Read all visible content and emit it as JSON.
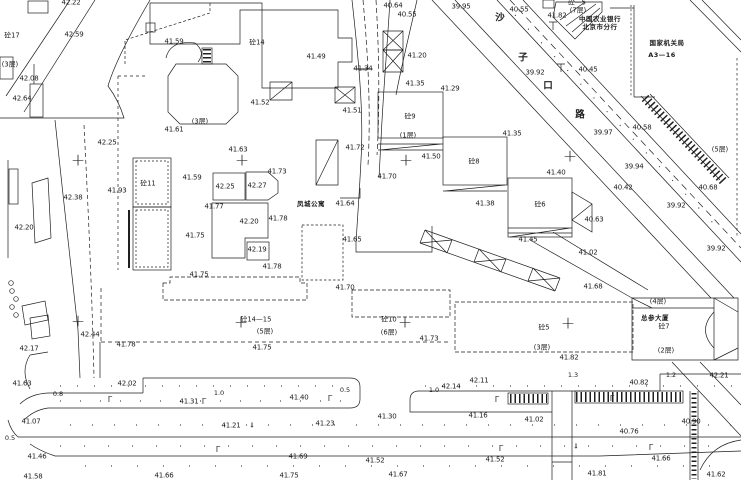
{
  "canvas": {
    "width": 741,
    "height": 480,
    "background": "#ffffff",
    "ink": "#1c1c1c"
  },
  "symbols": {
    "cross_glyph": "+",
    "lamp_glyph": "Γ",
    "arrow_glyph": "⇓"
  },
  "labels": {
    "elevations": [
      {
        "t": "42.22",
        "x": 71,
        "y": 3
      },
      {
        "t": "42.59",
        "x": 74,
        "y": 35
      },
      {
        "t": "41.59",
        "x": 174,
        "y": 42
      },
      {
        "t": "42.08",
        "x": 29,
        "y": 79
      },
      {
        "t": "42.64",
        "x": 22,
        "y": 99
      },
      {
        "t": "41.61",
        "x": 174,
        "y": 130
      },
      {
        "t": "42.25",
        "x": 107,
        "y": 143
      },
      {
        "t": "41.63",
        "x": 238,
        "y": 150
      },
      {
        "t": "40.64",
        "x": 393,
        "y": 6
      },
      {
        "t": "40.55",
        "x": 407,
        "y": 15
      },
      {
        "t": "39.95",
        "x": 461,
        "y": 7
      },
      {
        "t": "40.55",
        "x": 519,
        "y": 10
      },
      {
        "t": "41.82",
        "x": 557,
        "y": 16
      },
      {
        "t": "41.49",
        "x": 316,
        "y": 57
      },
      {
        "t": "41.34",
        "x": 363,
        "y": 69,
        "s": 1
      },
      {
        "t": "41.20",
        "x": 417,
        "y": 56
      },
      {
        "t": "41.35",
        "x": 415,
        "y": 84
      },
      {
        "t": "41.29",
        "x": 450,
        "y": 89
      },
      {
        "t": "41.52",
        "x": 260,
        "y": 103
      },
      {
        "t": "41.51",
        "x": 352,
        "y": 111
      },
      {
        "t": "41.35",
        "x": 512,
        "y": 134
      },
      {
        "t": "39.92",
        "x": 535,
        "y": 73
      },
      {
        "t": "40.45",
        "x": 588,
        "y": 70
      },
      {
        "t": "40.58",
        "x": 642,
        "y": 128
      },
      {
        "t": "39.97",
        "x": 603,
        "y": 133
      },
      {
        "t": "39.94",
        "x": 634,
        "y": 167
      },
      {
        "t": "40.42",
        "x": 623,
        "y": 188
      },
      {
        "t": "39.92",
        "x": 676,
        "y": 206
      },
      {
        "t": "40.68",
        "x": 708,
        "y": 188
      },
      {
        "t": "40.63",
        "x": 594,
        "y": 220
      },
      {
        "t": "39.92",
        "x": 716,
        "y": 249
      },
      {
        "t": "41.93",
        "x": 117,
        "y": 191
      },
      {
        "t": "41.59",
        "x": 192,
        "y": 178
      },
      {
        "t": "42.25",
        "x": 225,
        "y": 187
      },
      {
        "t": "42.27",
        "x": 257,
        "y": 186
      },
      {
        "t": "41.73",
        "x": 277,
        "y": 172
      },
      {
        "t": "41.77",
        "x": 214,
        "y": 207
      },
      {
        "t": "42.20",
        "x": 249,
        "y": 222
      },
      {
        "t": "41.78",
        "x": 278,
        "y": 219
      },
      {
        "t": "41.75",
        "x": 195,
        "y": 236
      },
      {
        "t": "42.19",
        "x": 257,
        "y": 250
      },
      {
        "t": "41.78",
        "x": 272,
        "y": 267
      },
      {
        "t": "41.75",
        "x": 199,
        "y": 275
      },
      {
        "t": "41.64",
        "x": 345,
        "y": 204
      },
      {
        "t": "41.70",
        "x": 387,
        "y": 177
      },
      {
        "t": "41.72",
        "x": 355,
        "y": 148
      },
      {
        "t": "41.50",
        "x": 431,
        "y": 157
      },
      {
        "t": "41.65",
        "x": 352,
        "y": 240
      },
      {
        "t": "41.70",
        "x": 345,
        "y": 288
      },
      {
        "t": "42.38",
        "x": 73,
        "y": 198
      },
      {
        "t": "42.20",
        "x": 24,
        "y": 228
      },
      {
        "t": "42.44",
        "x": 90,
        "y": 335
      },
      {
        "t": "42.17",
        "x": 29,
        "y": 349
      },
      {
        "t": "41.78",
        "x": 126,
        "y": 345
      },
      {
        "t": "41.40",
        "x": 556,
        "y": 173
      },
      {
        "t": "41.38",
        "x": 485,
        "y": 204
      },
      {
        "t": "41.45",
        "x": 528,
        "y": 240
      },
      {
        "t": "41.02",
        "x": 588,
        "y": 253
      },
      {
        "t": "41.68",
        "x": 593,
        "y": 287
      },
      {
        "t": "41.82",
        "x": 569,
        "y": 358
      },
      {
        "t": "41.75",
        "x": 262,
        "y": 348
      },
      {
        "t": "41.73",
        "x": 429,
        "y": 339
      },
      {
        "t": "41.63",
        "x": 22,
        "y": 384
      },
      {
        "t": "42.02",
        "x": 127,
        "y": 384
      },
      {
        "t": "41.31",
        "x": 189,
        "y": 402
      },
      {
        "t": "41.40",
        "x": 299,
        "y": 398
      },
      {
        "t": "42.14",
        "x": 451,
        "y": 387
      },
      {
        "t": "42.11",
        "x": 479,
        "y": 381
      },
      {
        "t": "40.82",
        "x": 639,
        "y": 383
      },
      {
        "t": "42.21",
        "x": 719,
        "y": 376
      },
      {
        "t": "41.07",
        "x": 31,
        "y": 422
      },
      {
        "t": "41.21",
        "x": 231,
        "y": 426
      },
      {
        "t": "41.23",
        "x": 325,
        "y": 424
      },
      {
        "t": "41.30",
        "x": 387,
        "y": 417
      },
      {
        "t": "41.16",
        "x": 478,
        "y": 416
      },
      {
        "t": "41.02",
        "x": 534,
        "y": 420
      },
      {
        "t": "40.76",
        "x": 629,
        "y": 432
      },
      {
        "t": "40.90",
        "x": 691,
        "y": 422
      },
      {
        "t": "41.46",
        "x": 37,
        "y": 457
      },
      {
        "t": "41.58",
        "x": 33,
        "y": 477
      },
      {
        "t": "41.66",
        "x": 164,
        "y": 476
      },
      {
        "t": "41.69",
        "x": 298,
        "y": 457
      },
      {
        "t": "41.75",
        "x": 289,
        "y": 476
      },
      {
        "t": "41.52",
        "x": 375,
        "y": 461
      },
      {
        "t": "41.67",
        "x": 398,
        "y": 475
      },
      {
        "t": "41.52",
        "x": 495,
        "y": 460
      },
      {
        "t": "41.66",
        "x": 661,
        "y": 459
      },
      {
        "t": "41.81",
        "x": 597,
        "y": 474
      },
      {
        "t": "41.62",
        "x": 716,
        "y": 475
      }
    ],
    "buildings": [
      {
        "t": "砼17",
        "x": 12,
        "y": 36
      },
      {
        "t": "砼14",
        "x": 257,
        "y": 43
      },
      {
        "t": "砼—5",
        "x": 577,
        "y": 3
      },
      {
        "t": "砼11",
        "x": 148,
        "y": 184
      },
      {
        "t": "砼9",
        "x": 410,
        "y": 117
      },
      {
        "t": "砼8",
        "x": 474,
        "y": 162
      },
      {
        "t": "砼6",
        "x": 540,
        "y": 205
      },
      {
        "t": "砼14—15",
        "x": 256,
        "y": 320
      },
      {
        "t": "砼10",
        "x": 389,
        "y": 320
      },
      {
        "t": "砼5",
        "x": 544,
        "y": 328
      },
      {
        "t": "砼7",
        "x": 664,
        "y": 327
      }
    ],
    "floors": [
      {
        "t": "(3层)",
        "x": 10,
        "y": 65
      },
      {
        "t": "(3层)",
        "x": 200,
        "y": 122
      },
      {
        "t": "(7层)",
        "x": 578,
        "y": 11
      },
      {
        "t": "(1层)",
        "x": 408,
        "y": 136
      },
      {
        "t": "(5层)",
        "x": 720,
        "y": 150
      },
      {
        "t": "(5层)",
        "x": 265,
        "y": 332
      },
      {
        "t": "(6层)",
        "x": 389,
        "y": 333
      },
      {
        "t": "(3层)",
        "x": 542,
        "y": 348
      },
      {
        "t": "(2层)",
        "x": 666,
        "y": 351
      },
      {
        "t": "(4层)",
        "x": 658,
        "y": 302
      }
    ],
    "notes": [
      {
        "t": "中国农业银行",
        "x": 600,
        "y": 19
      },
      {
        "t": "北京市分行",
        "x": 600,
        "y": 27
      },
      {
        "t": "国家机关局",
        "x": 667,
        "y": 43
      },
      {
        "t": "A3—16",
        "x": 662,
        "y": 55
      },
      {
        "t": "凤城公寓",
        "x": 311,
        "y": 204
      },
      {
        "t": "总参大厦",
        "x": 655,
        "y": 318
      }
    ],
    "street": [
      {
        "t": "沙",
        "x": 500,
        "y": 18
      },
      {
        "t": "子",
        "x": 523,
        "y": 58
      },
      {
        "t": "口",
        "x": 548,
        "y": 86
      },
      {
        "t": "路",
        "x": 580,
        "y": 115
      }
    ],
    "dims": [
      {
        "t": "0.8",
        "x": 58,
        "y": 394
      },
      {
        "t": "1.0",
        "x": 219,
        "y": 393
      },
      {
        "t": "0.5",
        "x": 345,
        "y": 390
      },
      {
        "t": "1.0",
        "x": 434,
        "y": 390
      },
      {
        "t": "1.3",
        "x": 573,
        "y": 375
      },
      {
        "t": "1.2",
        "x": 671,
        "y": 375
      },
      {
        "t": "0.5",
        "x": 10,
        "y": 438
      }
    ],
    "crosses": [
      {
        "x": 78,
        "y": 161
      },
      {
        "x": 242,
        "y": 161
      },
      {
        "x": 406,
        "y": 161
      },
      {
        "x": 570,
        "y": 157
      },
      {
        "x": 78,
        "y": 322
      },
      {
        "x": 241,
        "y": 323
      },
      {
        "x": 405,
        "y": 323
      },
      {
        "x": 568,
        "y": 324
      }
    ],
    "lamps": [
      {
        "x": 110,
        "y": 400
      },
      {
        "x": 204,
        "y": 402
      },
      {
        "x": 330,
        "y": 399
      },
      {
        "x": 497,
        "y": 400
      },
      {
        "x": 612,
        "y": 399
      },
      {
        "x": 218,
        "y": 450
      },
      {
        "x": 501,
        "y": 449
      },
      {
        "x": 651,
        "y": 448
      }
    ],
    "arrows": [
      {
        "x": 252,
        "y": 426
      },
      {
        "x": 576,
        "y": 447
      }
    ]
  }
}
